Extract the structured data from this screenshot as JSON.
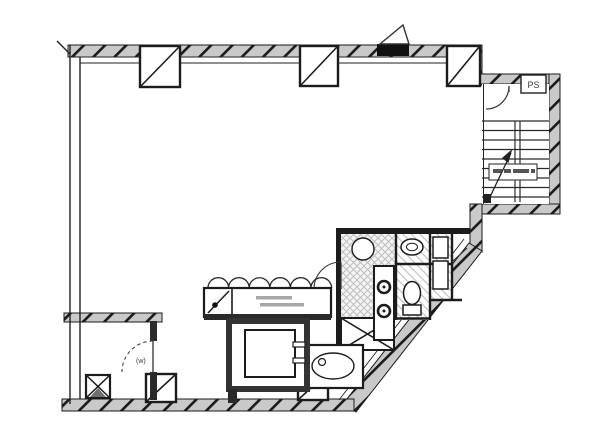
{
  "document": {
    "kind": "architectural floor plan",
    "style": "scanned monochrome blueprint",
    "canvas": {
      "width": 600,
      "height": 443
    }
  },
  "colors": {
    "background": "#ffffff",
    "ink": "#1e1e1e",
    "wall_fill": "#c9c9c9",
    "floor_hatch": "#bdbdbd",
    "mark_gray": "#8a8a8a"
  },
  "labels": {
    "stair_pipe_shaft": "PS",
    "storage_window_marker": "(w)"
  },
  "features": {
    "stairwell": "two-flight staircase with mid landing and up line",
    "elevator": "elevator shaft with car and side door",
    "service_core": "kitchenette, WC and utility cells on tiled floors",
    "scalloped_counter": "counter with scalloped front edge",
    "storage_room": "bottom-left room with dashed door swing and shaft box",
    "entry_door": "top wall door with triangular leaf symbol",
    "columns": "square columns with diagonal brace marks"
  }
}
